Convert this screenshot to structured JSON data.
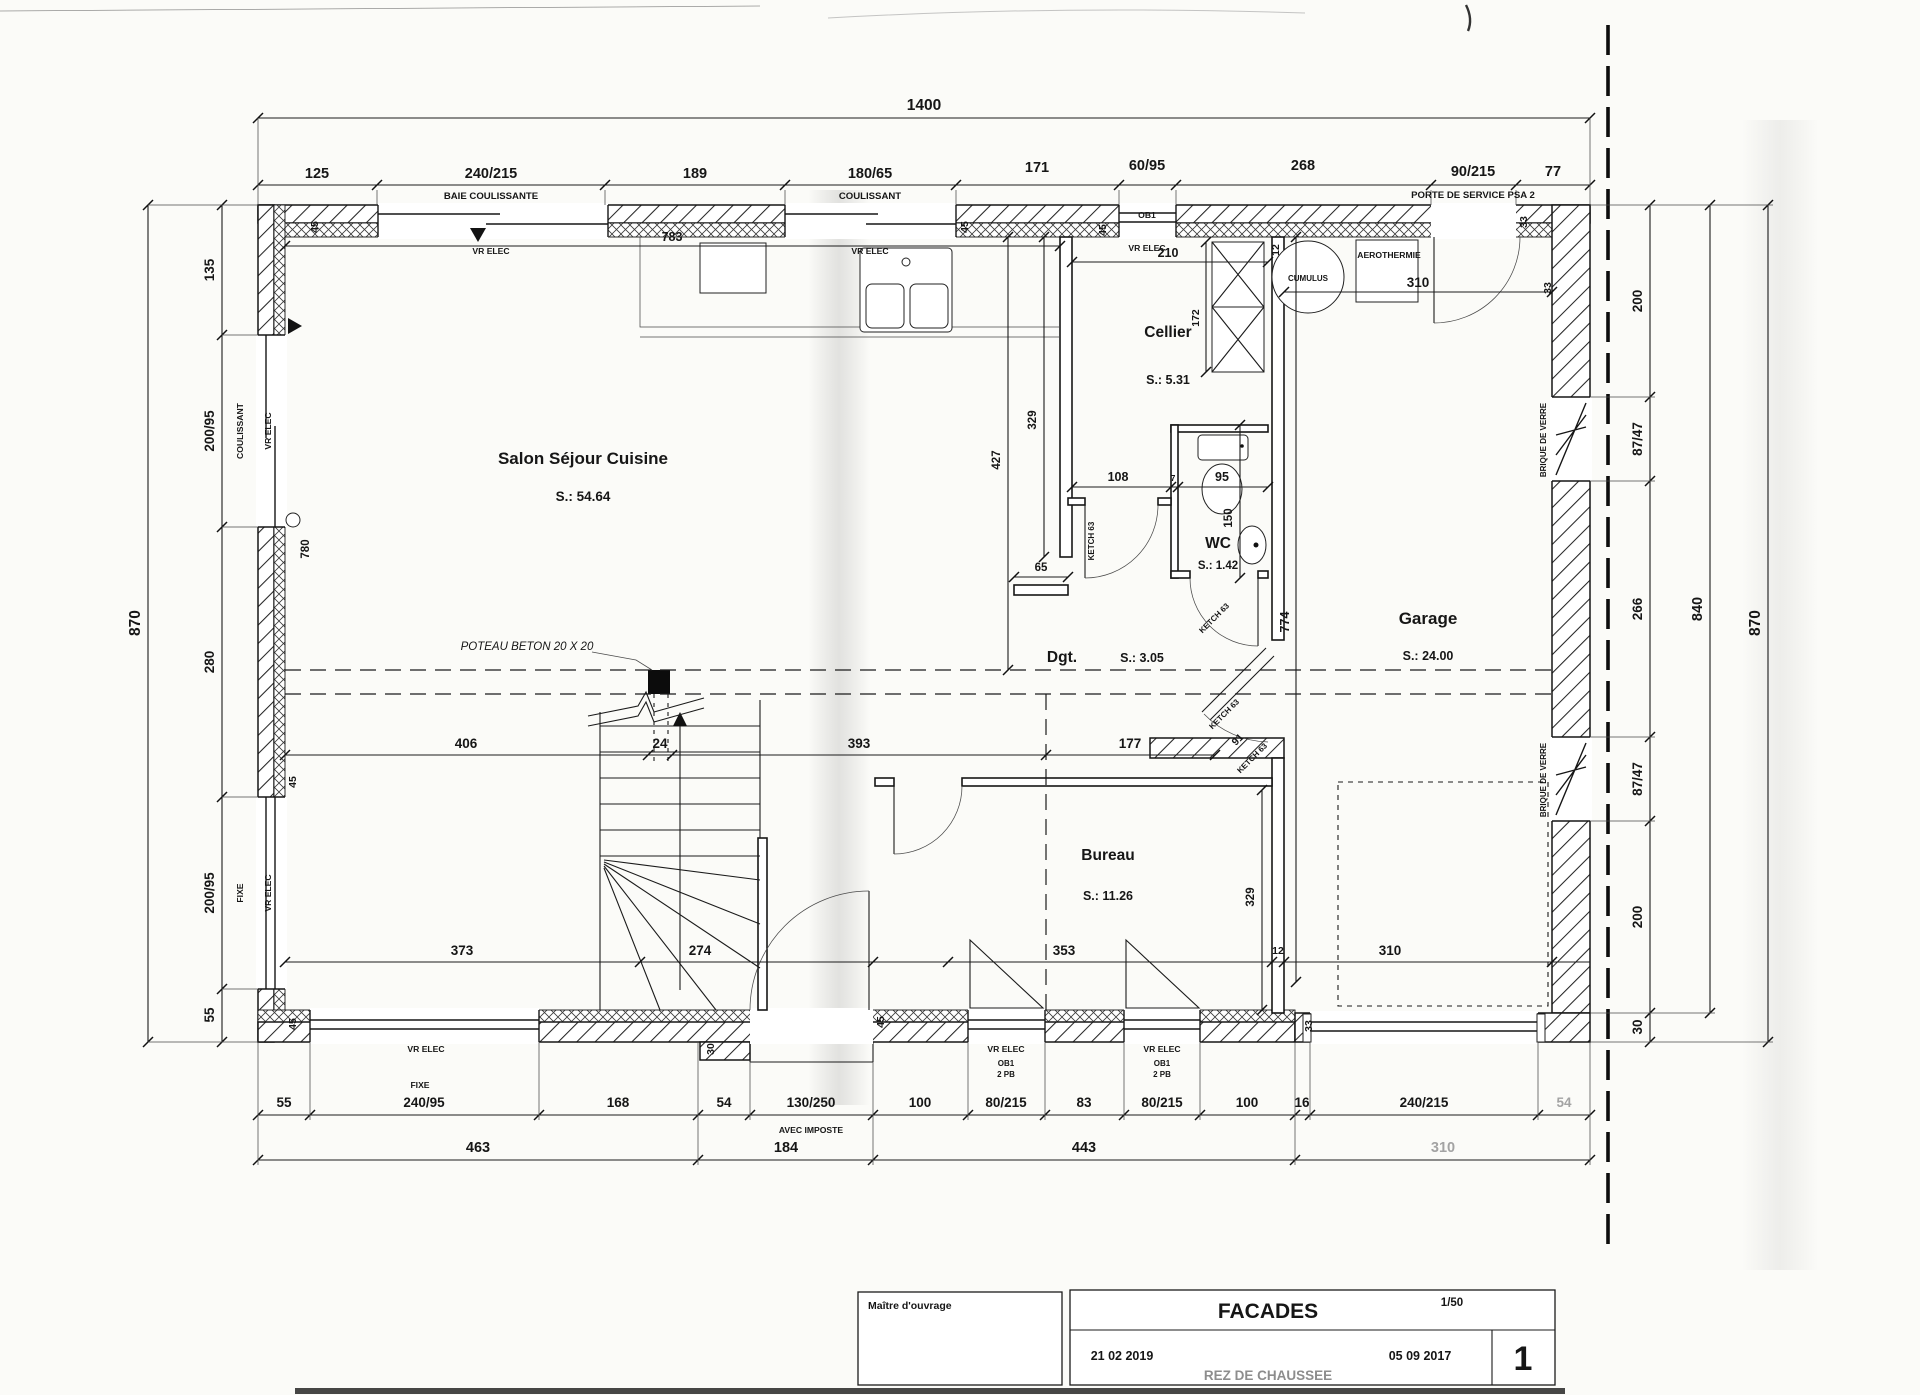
{
  "title_block": {
    "owner": "Maître d'ouvrage",
    "date_revision": "21 02 2019",
    "title": "FACADES",
    "floor": "REZ DE CHAUSSEE",
    "scale": "1/50",
    "date_original": "05 09 2017",
    "sheet": "1"
  },
  "rooms": {
    "salon": {
      "name": "Salon Séjour Cuisine",
      "area": "S.: 54.64"
    },
    "cellier": {
      "name": "Cellier",
      "area": "S.: 5.31"
    },
    "wc": {
      "name": "WC",
      "area": "S.: 1.42"
    },
    "dgt": {
      "name": "Dgt.",
      "area": "S.: 3.05"
    },
    "garage": {
      "name": "Garage",
      "area": "S.: 24.00"
    },
    "bureau": {
      "name": "Bureau",
      "area": "S.: 11.26"
    }
  },
  "dims": {
    "overall_top": "1400",
    "top": [
      "125",
      "240/215",
      "189",
      "180/65",
      "171",
      "60/95",
      "268",
      "90/215",
      "77"
    ],
    "left_overall": "870",
    "left": [
      "135",
      "200/95",
      "280",
      "200/95",
      "55"
    ],
    "right": [
      "200",
      "87/47",
      "266",
      "87/47",
      "200",
      "30"
    ],
    "right_inner": "840",
    "right_overall": "870",
    "bottom": [
      "55",
      "240/95",
      "168",
      "54",
      "130/250",
      "100",
      "80/215",
      "83",
      "80/215",
      "100",
      "16",
      "240/215",
      "54"
    ],
    "bottom_totals": [
      "463",
      "184",
      "443",
      "310"
    ],
    "mid": [
      "406",
      "24",
      "393",
      "177"
    ],
    "lower": [
      "373",
      "274",
      "353",
      "12",
      "310"
    ],
    "salon_width": "783",
    "cellier_width": "210",
    "garage_width": "310",
    "wall12": "12",
    "wall33": "33",
    "wall45": "45",
    "step30": "30",
    "kitchen_depth": "427",
    "kitchen_wall": "329",
    "stub": "65",
    "wc_w1": "108",
    "wc_w2": "7",
    "wc_w3": "95",
    "wc_h": "150",
    "shelf": "172",
    "garage_depth": "774",
    "bureau_depth": "329",
    "door_diag": "91",
    "interior_h": "780"
  },
  "annotations": {
    "baie": "BAIE COULISSANTE",
    "coulissant": "COULISSANT",
    "vr": "VR ELEC",
    "ob1": "OB1",
    "porte": "PORTE DE SERVICE PSA 2",
    "fixe": "FIXE",
    "imposte": "AVEC IMPOSTE",
    "ob1_2pb_1": "OB1",
    "ob1_2pb_2": "2 PB",
    "brique": "BRIQUE DE VERRE",
    "cumulus": "CUMULUS",
    "aero": "AEROTHERMIE",
    "ketch": "KETCH 63",
    "poteau": "POTEAU BETON  20 X 20"
  }
}
